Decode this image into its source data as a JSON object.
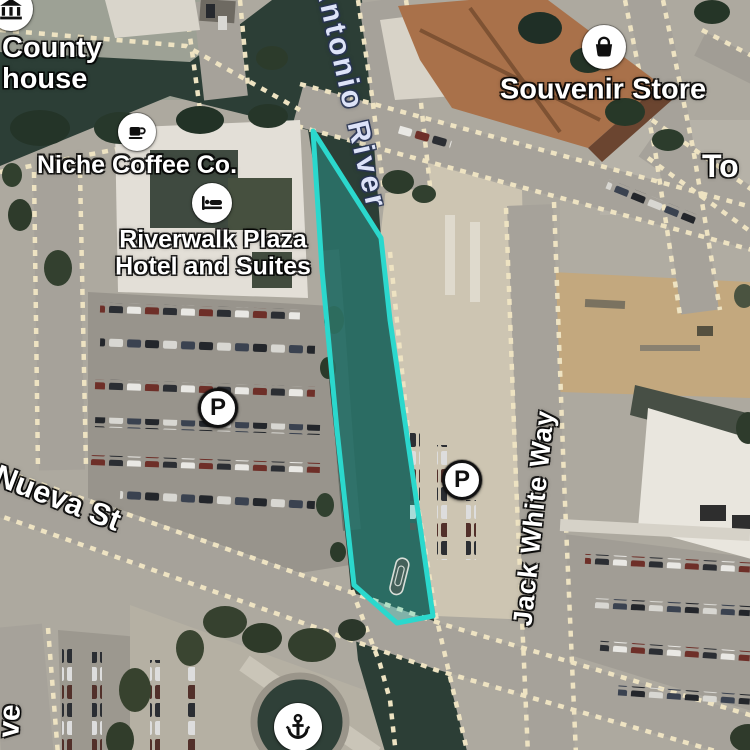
{
  "selection": {
    "stroke": "#2BD8CD",
    "fill": "rgba(43,216,205,0.30)"
  },
  "pois": {
    "courthouse": {
      "line1": "County",
      "line2": "house",
      "icon": "bank-icon"
    },
    "coffee_shop": {
      "label": "Niche Coffee Co.",
      "icon": "coffee-icon"
    },
    "hotel": {
      "line1": "Riverwalk Plaza",
      "line2": "Hotel and Suites",
      "icon": "bed-icon"
    },
    "souvenir_store": {
      "label": "Souvenir Store",
      "icon": "bag-icon"
    },
    "parking_west": {
      "label": "P",
      "icon": "parking-icon"
    },
    "parking_east": {
      "label": "P",
      "icon": "parking-icon"
    },
    "river_landing": {
      "icon": "anchor-icon"
    }
  },
  "streets": {
    "san_antonio_river": {
      "label": "Antonio River"
    },
    "jack_white_way": {
      "label": "Jack White Way"
    },
    "nueva_st": {
      "label": "E Nueva St"
    },
    "edge_label_right": {
      "label": "To"
    },
    "edge_label_left": {
      "label": "ve"
    }
  },
  "map_colors": {
    "river": "#2C3E36",
    "road": "#A6A29A",
    "road_dash": "#EEE3C2",
    "parking_lot": "#98948C",
    "roof_terracotta": "#A9714A"
  }
}
